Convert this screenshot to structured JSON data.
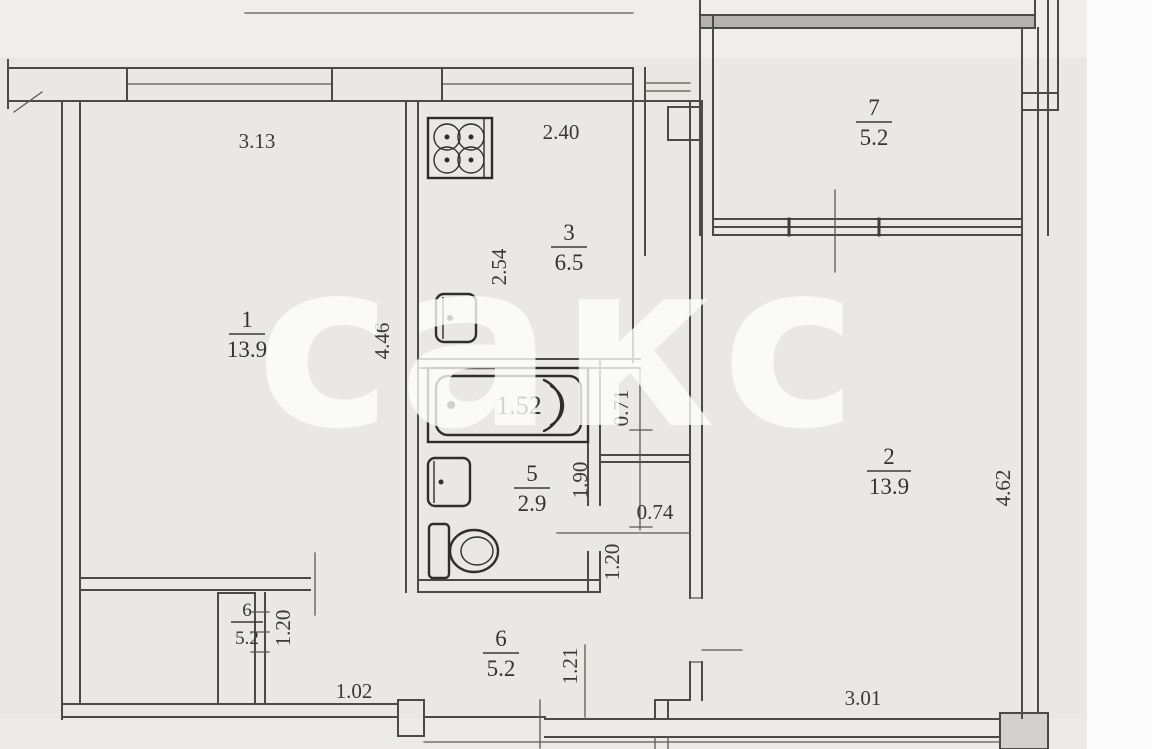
{
  "document": {
    "type": "apartment-floor-plan-scan",
    "watermark": "сакс"
  },
  "colors": {
    "paper": "#e9e8e5",
    "paper_light": "#efeeec",
    "margin": "#fcfcfc",
    "wall_line": "#4a4a46",
    "text": "#3a3a35",
    "watermark": "rgba(255,255,255,0.78)"
  },
  "rooms": [
    {
      "id": "living-room-1",
      "number": "1",
      "area": "13.9"
    },
    {
      "id": "living-room-2",
      "number": "2",
      "area": "13.9"
    },
    {
      "id": "kitchen",
      "number": "3",
      "area": "6.5"
    },
    {
      "id": "bathroom",
      "number": "5",
      "area": "2.9"
    },
    {
      "id": "hallway",
      "number": "6",
      "area": "5.2"
    },
    {
      "id": "closet",
      "number": "6",
      "area": "5.2"
    },
    {
      "id": "balcony",
      "number": "7",
      "area": "5.2"
    }
  ],
  "dimensions": {
    "room1_width": "3.13",
    "kitchen_width": "2.40",
    "room1_depth": "4.46",
    "kitchen_depth": "2.54",
    "duct_depth": "0.71",
    "bath_length": "1.90",
    "tub_length": "1.52",
    "passage_width": "0.74",
    "bath_door": "1.20",
    "closet_width": "1.20",
    "entry_width": "1.02",
    "hall_depth": "1.21",
    "room2_depth": "4.62",
    "room2_width": "3.01"
  },
  "fixtures": [
    {
      "icon": "stove-icon"
    },
    {
      "icon": "kitchen-sink-icon"
    },
    {
      "icon": "bathtub-icon"
    },
    {
      "icon": "wash-basin-icon"
    },
    {
      "icon": "toilet-icon"
    }
  ]
}
